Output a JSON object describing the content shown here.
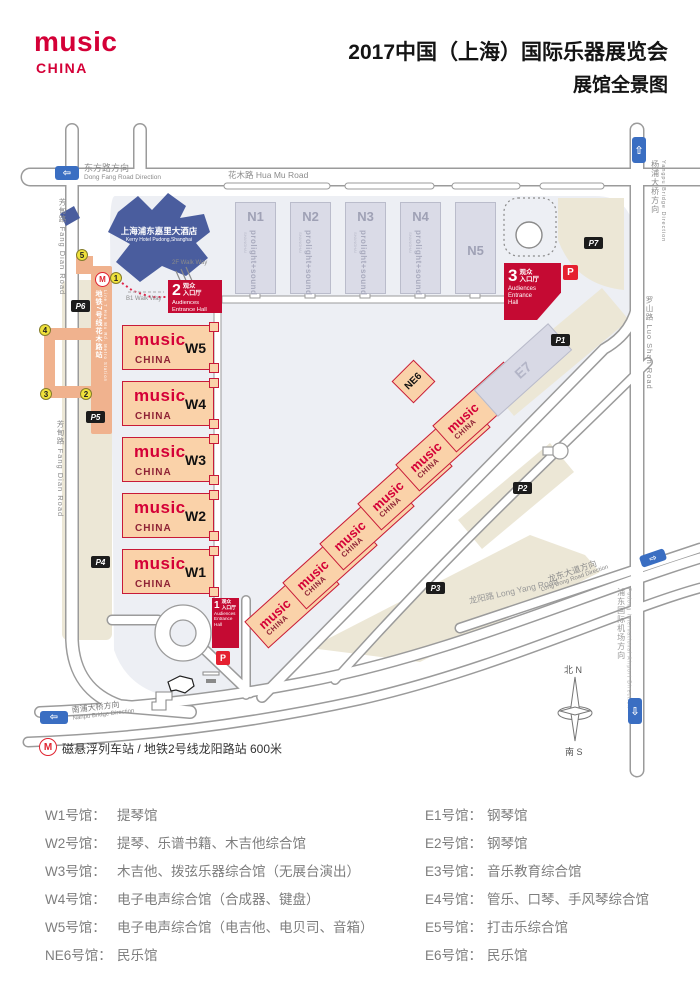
{
  "header": {
    "logo": {
      "line1": "music",
      "line2": "CHINA"
    },
    "title": {
      "line1": "2017中国（上海）国际乐器展览会",
      "line2": "展馆全景图"
    }
  },
  "brand": {
    "line1": "music",
    "line2": "CHINA"
  },
  "map": {
    "roads": {
      "dong_fang_zh": "东方路方向",
      "dong_fang_en": "Dong Fang Road Direction",
      "hua_mu": "花木路 Hua Mu Road",
      "fang_dian": "芳甸路 Fang Dian Road",
      "yangpu_zh": "杨浦大桥方向",
      "yangpu_en": "Yangpu Bridge Direction",
      "luo_shan": "罗山路 Luo Shan Road",
      "long_yang": "龙阳路 Long Yang Road",
      "long_dong_zh": "龙东大道方向",
      "long_dong_en": "Long Dong Road Direction",
      "airport_zh": "浦东国际机场方向",
      "airport_en": "Pudong International Airport Direction",
      "nanpu_zh": "南浦大桥方向",
      "nanpu_en": "Nanpu Bridge Direction"
    },
    "hotel": {
      "zh": "上海浦东嘉里大酒店",
      "en": "Kerry Hotel Pudong,Shanghai"
    },
    "metro_station": {
      "zh": "地铁7号线花木路站",
      "en": "Line 7 Hua Mu Rd. Metro Station",
      "m": "M"
    },
    "walkways": {
      "f2": "2F Walk Way",
      "b1": "B1 Walk Way"
    },
    "entrance": {
      "zh1": "观众",
      "zh2": "入口厅",
      "en": "Audiences Entrance Hall",
      "nums": [
        "1",
        "2",
        "3"
      ],
      "p": "P"
    },
    "parking_chips": [
      "P1",
      "P2",
      "P3",
      "P4",
      "P5",
      "P6",
      "P7"
    ],
    "markers": [
      "1",
      "2",
      "3",
      "4",
      "5"
    ],
    "north_halls": {
      "brand": "prolight+sound",
      "sub": "SHANGHAI",
      "ids": [
        "N1",
        "N2",
        "N3",
        "N4",
        "N5"
      ]
    },
    "west_halls": [
      "W5",
      "W4",
      "W3",
      "W2",
      "W1"
    ],
    "east_halls": [
      "E1",
      "E2",
      "E3",
      "E4",
      "E5",
      "E6"
    ],
    "ne_hall": "NE6",
    "e7_hall": "E7",
    "compass": {
      "north": "北 N",
      "south": "南 S"
    },
    "maglev": "磁悬浮列车站 / 地铁2号线龙阳路站  600米"
  },
  "legend": {
    "left": [
      {
        "label": "W1号馆：",
        "desc": "提琴馆"
      },
      {
        "label": "W2号馆：",
        "desc": "提琴、乐谱书籍、木吉他综合馆"
      },
      {
        "label": "W3号馆：",
        "desc": "木吉他、拨弦乐器综合馆（无展台演出）"
      },
      {
        "label": "W4号馆：",
        "desc": "电子电声综合馆（合成器、键盘）"
      },
      {
        "label": "W5号馆：",
        "desc": "电子电声综合馆（电吉他、电贝司、音箱）"
      },
      {
        "label": "NE6号馆：",
        "desc": "民乐馆"
      }
    ],
    "right": [
      {
        "label": "E1号馆：",
        "desc": "钢琴馆"
      },
      {
        "label": "E2号馆：",
        "desc": "钢琴馆"
      },
      {
        "label": "E3号馆：",
        "desc": "音乐教育综合馆"
      },
      {
        "label": "E4号馆：",
        "desc": "管乐、口琴、手风琴综合馆"
      },
      {
        "label": "E5号馆：",
        "desc": "打击乐综合馆"
      },
      {
        "label": "E6号馆：",
        "desc": "民乐馆"
      }
    ]
  }
}
